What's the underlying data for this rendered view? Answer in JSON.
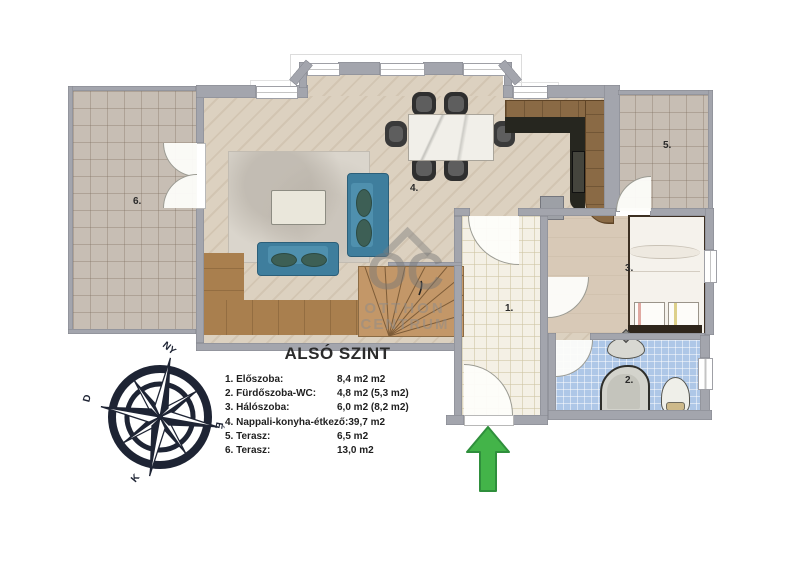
{
  "legend": {
    "title": "ALSÓ SZINT",
    "items": [
      {
        "label": "1. Előszoba:",
        "value": "8,4 m2 m2"
      },
      {
        "label": "2. Fürdőszoba-WC:",
        "value": "4,8 m2 (5,3 m2)"
      },
      {
        "label": "3. Hálószoba:",
        "value": "6,0 m2 (8,2 m2)"
      },
      {
        "label": "4. Nappali-konyha-étkező:",
        "value": "39,7 m2"
      },
      {
        "label": "5. Terasz:",
        "value": "6,5 m2"
      },
      {
        "label": "6. Terasz:",
        "value": "13,0 m2"
      }
    ]
  },
  "rooms": {
    "hall": "1.",
    "bath": "2.",
    "bedroom": "3.",
    "living": "4.",
    "terrace5": "5.",
    "terrace6": "6."
  },
  "compass": {
    "north": "É",
    "south": "D",
    "east": "K",
    "west": "NY"
  },
  "watermark": {
    "logo": "OC",
    "line1": "OTTHON",
    "line2": "CENTRUM"
  },
  "colors": {
    "wall": "#a3a5ad",
    "bath_tile": "#aec7e7",
    "sofa": "#3f7e9d",
    "arrow_green": "#43b449",
    "compass_navy": "#1e2434"
  }
}
